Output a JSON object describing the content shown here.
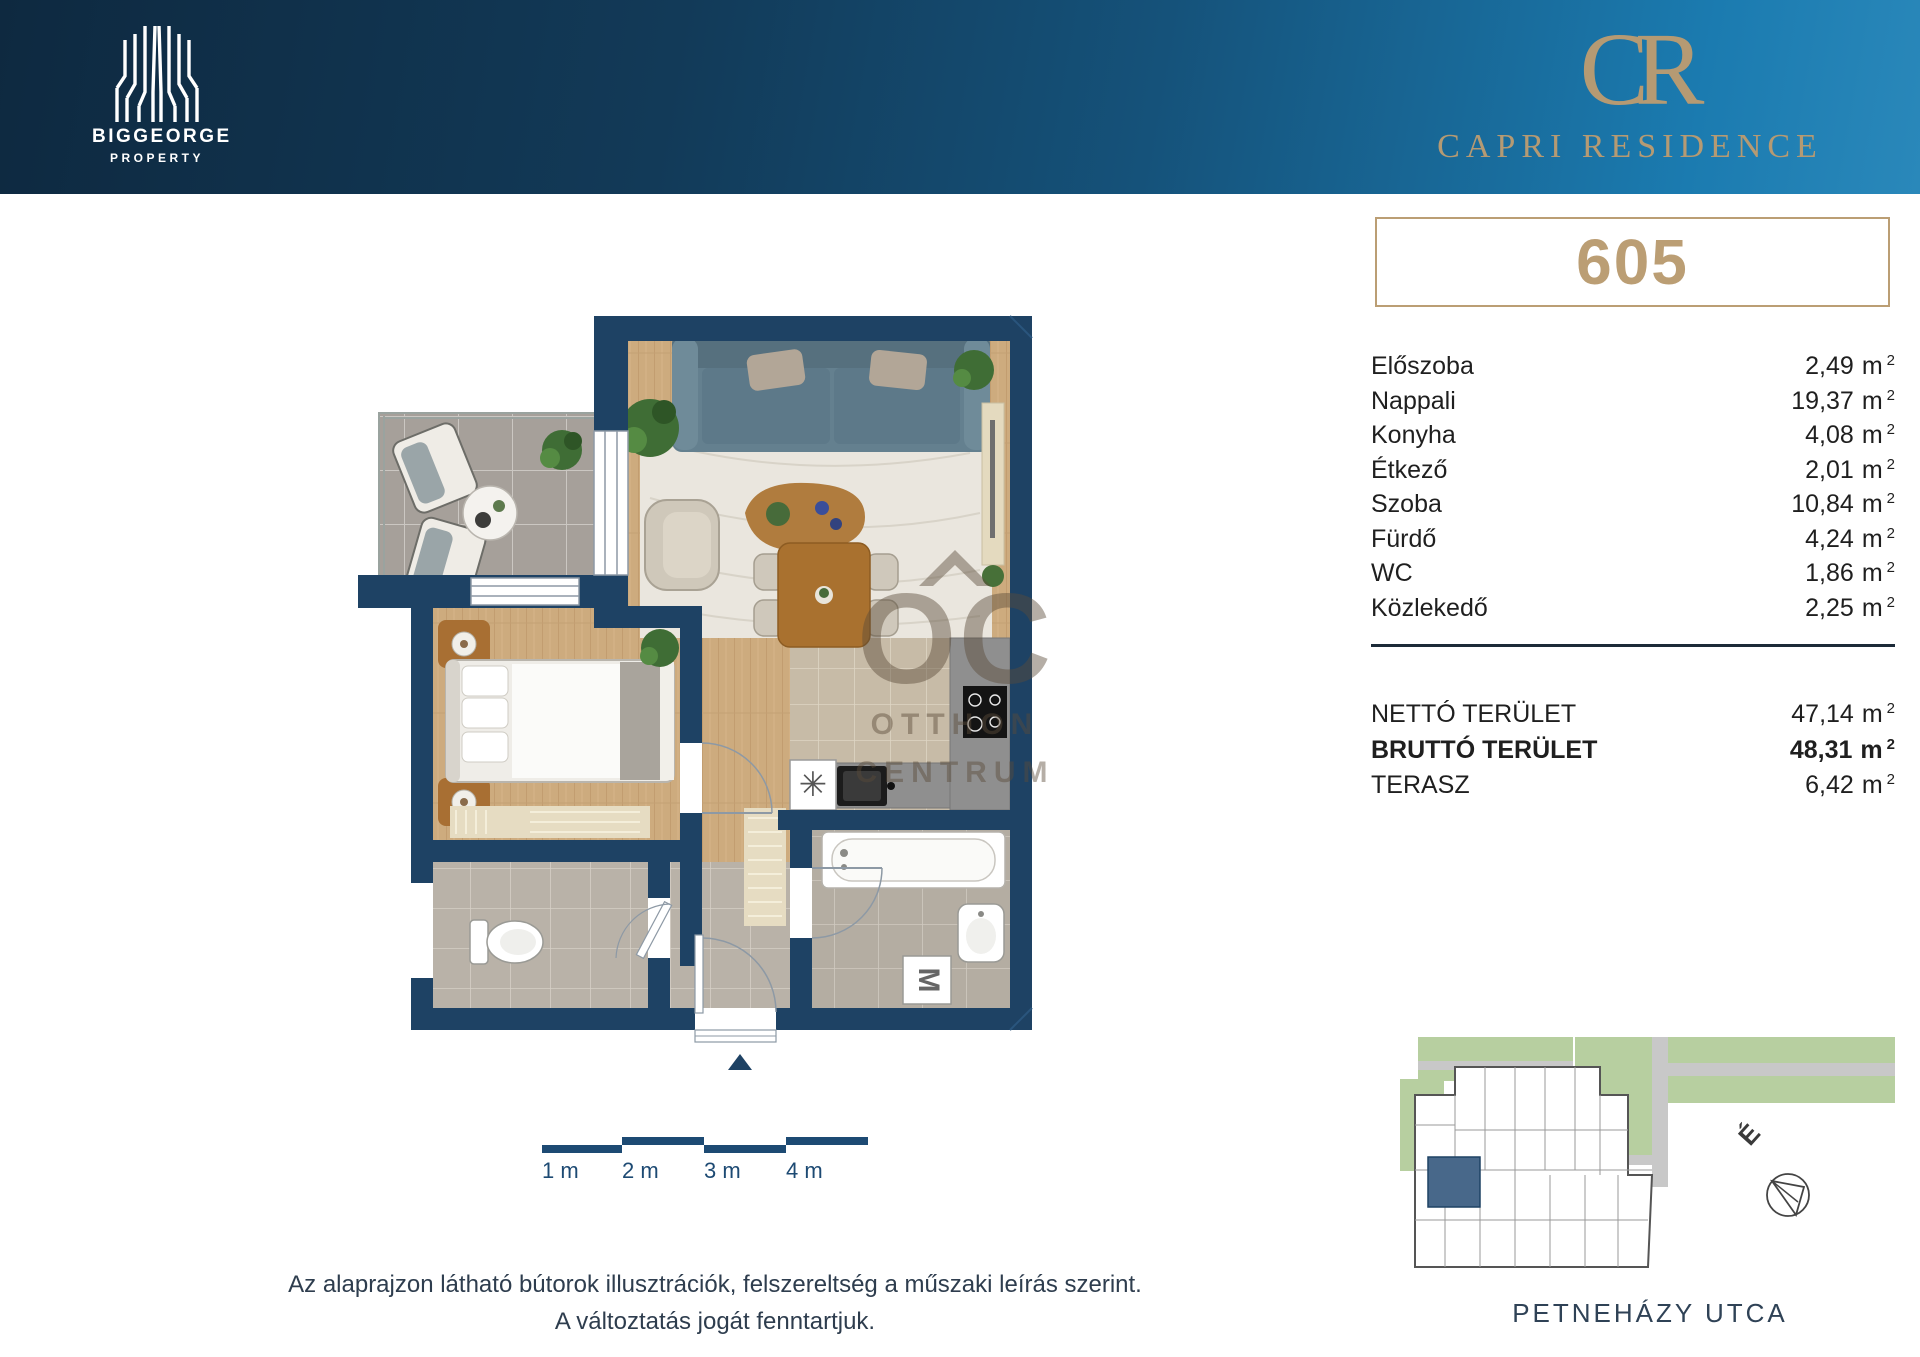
{
  "colors": {
    "navy_wall": "#1e4264",
    "gold": "#bb9e74",
    "header_dark": "#0e2940",
    "header_light": "#1b7bb0",
    "highlight_unit": "#48688a",
    "scale_navy": "#1d4a73"
  },
  "header": {
    "brand_name": "BIGGEORGE",
    "brand_sub": "PROPERTY",
    "monogram": "CR",
    "residence": "CAPRI RESIDENCE"
  },
  "unit": {
    "number": "605"
  },
  "meta": {
    "unit": "m",
    "sup": "2"
  },
  "rooms": [
    {
      "label": "Előszoba",
      "value": "2,49"
    },
    {
      "label": "Nappali",
      "value": "19,37"
    },
    {
      "label": "Konyha",
      "value": "4,08"
    },
    {
      "label": "Étkező",
      "value": "2,01"
    },
    {
      "label": "Szoba",
      "value": "10,84"
    },
    {
      "label": "Fürdő",
      "value": "4,24"
    },
    {
      "label": "WC",
      "value": "1,86"
    },
    {
      "label": "Közlekedő",
      "value": "2,25"
    }
  ],
  "totals": [
    {
      "label": "NETTÓ TERÜLET",
      "value": "47,14",
      "bold": false
    },
    {
      "label": "BRUTTÓ TERÜLET",
      "value": "48,31",
      "bold": true
    },
    {
      "label": "TERASZ",
      "value": "6,42",
      "bold": false
    }
  ],
  "scalebar": {
    "labels": [
      "1 m",
      "2 m",
      "3 m",
      "4 m"
    ]
  },
  "floorplan": {
    "washer_label": "M",
    "appliance_symbol": "✳"
  },
  "watermark": {
    "oc": "OC",
    "line1": "OTTHON",
    "line2": "CENTRUM"
  },
  "disclaimer": {
    "line1": "Az alaprajzon látható bútorok illusztrációk, felszereltség a műszaki leírás szerint.",
    "line2": "A változtatás jogát fenntartjuk."
  },
  "siteplan": {
    "street": "PETNEHÁZY UTCA",
    "north": "É"
  }
}
